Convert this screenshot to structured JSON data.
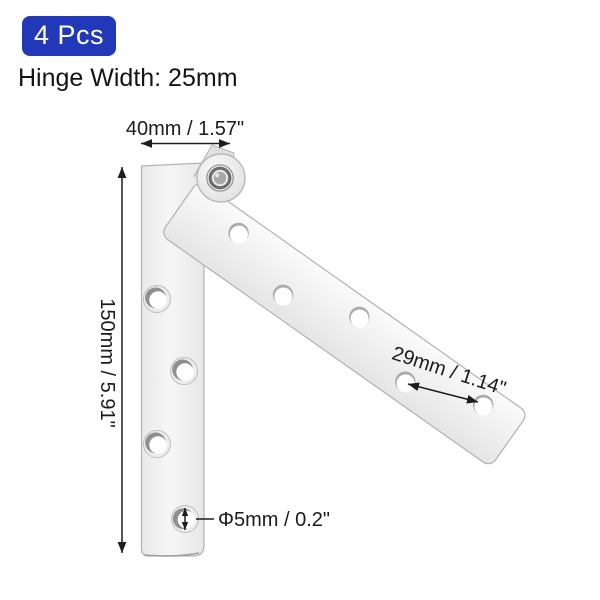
{
  "header": {
    "badge_label": "4 Pcs",
    "subtitle": "Hinge Width: 25mm"
  },
  "diagram": {
    "subject": "pivot-hinge-two-leaves-open-at-angle",
    "labels": {
      "leaf_width": "40mm / 1.57\"",
      "leaf_length": "150mm / 5.91\"",
      "hole_spacing": "29mm / 1.14\"",
      "hole_diameter": "Φ5mm / 0.2\""
    },
    "hole_count_vertical_leaf": 4,
    "hole_count_angled_leaf": 5
  },
  "colors": {
    "badge_blue": "#2139b8",
    "annotation_text": "#1b1b1b",
    "dimension_line": "#1d1d1d",
    "metal_light": "#f7f7f7",
    "metal_edge": "#b2b2b2",
    "background": "#ffffff"
  }
}
